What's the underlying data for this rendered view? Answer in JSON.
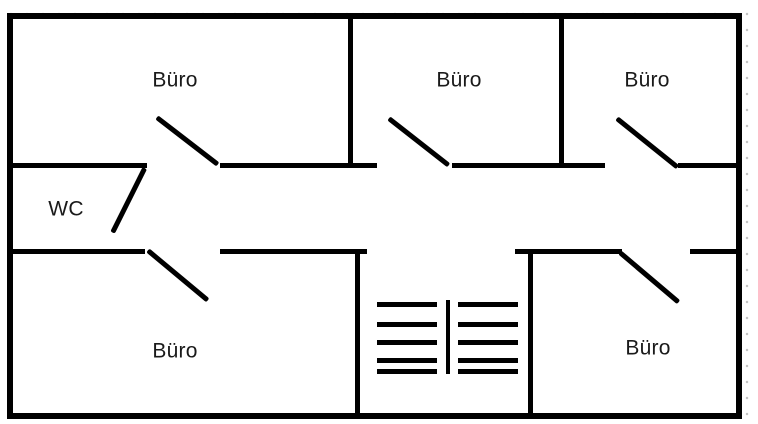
{
  "diagram": {
    "type": "floor-plan",
    "colors": {
      "wall": "#000000",
      "label": "#1a1a1a",
      "grid_dot": "#c4c4c4",
      "background": "#ffffff"
    },
    "grid": {
      "dot_spacing_px": 16
    },
    "outer_wall": {
      "x": 7,
      "y": 13,
      "w": 735,
      "h": 406,
      "thickness": 6
    },
    "rooms": [
      {
        "id": "buero-top-left",
        "label": "Büro",
        "cx": 175,
        "cy": 80
      },
      {
        "id": "buero-top-middle",
        "label": "Büro",
        "cx": 459,
        "cy": 80
      },
      {
        "id": "buero-top-right",
        "label": "Büro",
        "cx": 647,
        "cy": 80
      },
      {
        "id": "wc",
        "label": "WC",
        "cx": 66,
        "cy": 209
      },
      {
        "id": "buero-bottom-left",
        "label": "Büro",
        "cx": 175,
        "cy": 351
      },
      {
        "id": "buero-bottom-right",
        "label": "Büro",
        "cx": 648,
        "cy": 348
      }
    ],
    "walls": [
      {
        "x": 13,
        "y": 163,
        "w": 134,
        "h": 5
      },
      {
        "x": 220,
        "y": 163,
        "w": 157,
        "h": 5
      },
      {
        "x": 452,
        "y": 163,
        "w": 153,
        "h": 5
      },
      {
        "x": 678,
        "y": 163,
        "w": 58,
        "h": 5
      },
      {
        "x": 13,
        "y": 249,
        "w": 132,
        "h": 5
      },
      {
        "x": 220,
        "y": 249,
        "w": 147,
        "h": 5
      },
      {
        "x": 515,
        "y": 249,
        "w": 107,
        "h": 5
      },
      {
        "x": 690,
        "y": 249,
        "w": 46,
        "h": 5
      },
      {
        "x": 348,
        "y": 19,
        "w": 5,
        "h": 149
      },
      {
        "x": 559,
        "y": 19,
        "w": 5,
        "h": 149
      },
      {
        "x": 355,
        "y": 249,
        "w": 5,
        "h": 164
      },
      {
        "x": 528,
        "y": 249,
        "w": 5,
        "h": 164
      }
    ],
    "doors": [
      {
        "id": "door-buero-top-left",
        "x1": 157,
        "y1": 117,
        "x2": 218,
        "y2": 164
      },
      {
        "id": "door-buero-top-middle",
        "x1": 389,
        "y1": 118,
        "x2": 449,
        "y2": 165
      },
      {
        "id": "door-buero-top-right",
        "x1": 617,
        "y1": 118,
        "x2": 678,
        "y2": 167
      },
      {
        "id": "door-wc",
        "x1": 145,
        "y1": 168,
        "x2": 113,
        "y2": 232
      },
      {
        "id": "door-buero-bottom-left",
        "x1": 148,
        "y1": 250,
        "x2": 208,
        "y2": 300
      },
      {
        "id": "door-buero-bottom-right",
        "x1": 620,
        "y1": 252,
        "x2": 679,
        "y2": 302
      }
    ],
    "door_thickness": 4.5,
    "stairs": {
      "left_flight": {
        "x": 377,
        "step_w": 60
      },
      "right_flight": {
        "x": 458,
        "step_w": 60
      },
      "step_ys": [
        302,
        322,
        340,
        358,
        369
      ],
      "step_h": 5,
      "rail": {
        "x": 446,
        "y": 300,
        "w": 4,
        "h": 74
      }
    }
  }
}
